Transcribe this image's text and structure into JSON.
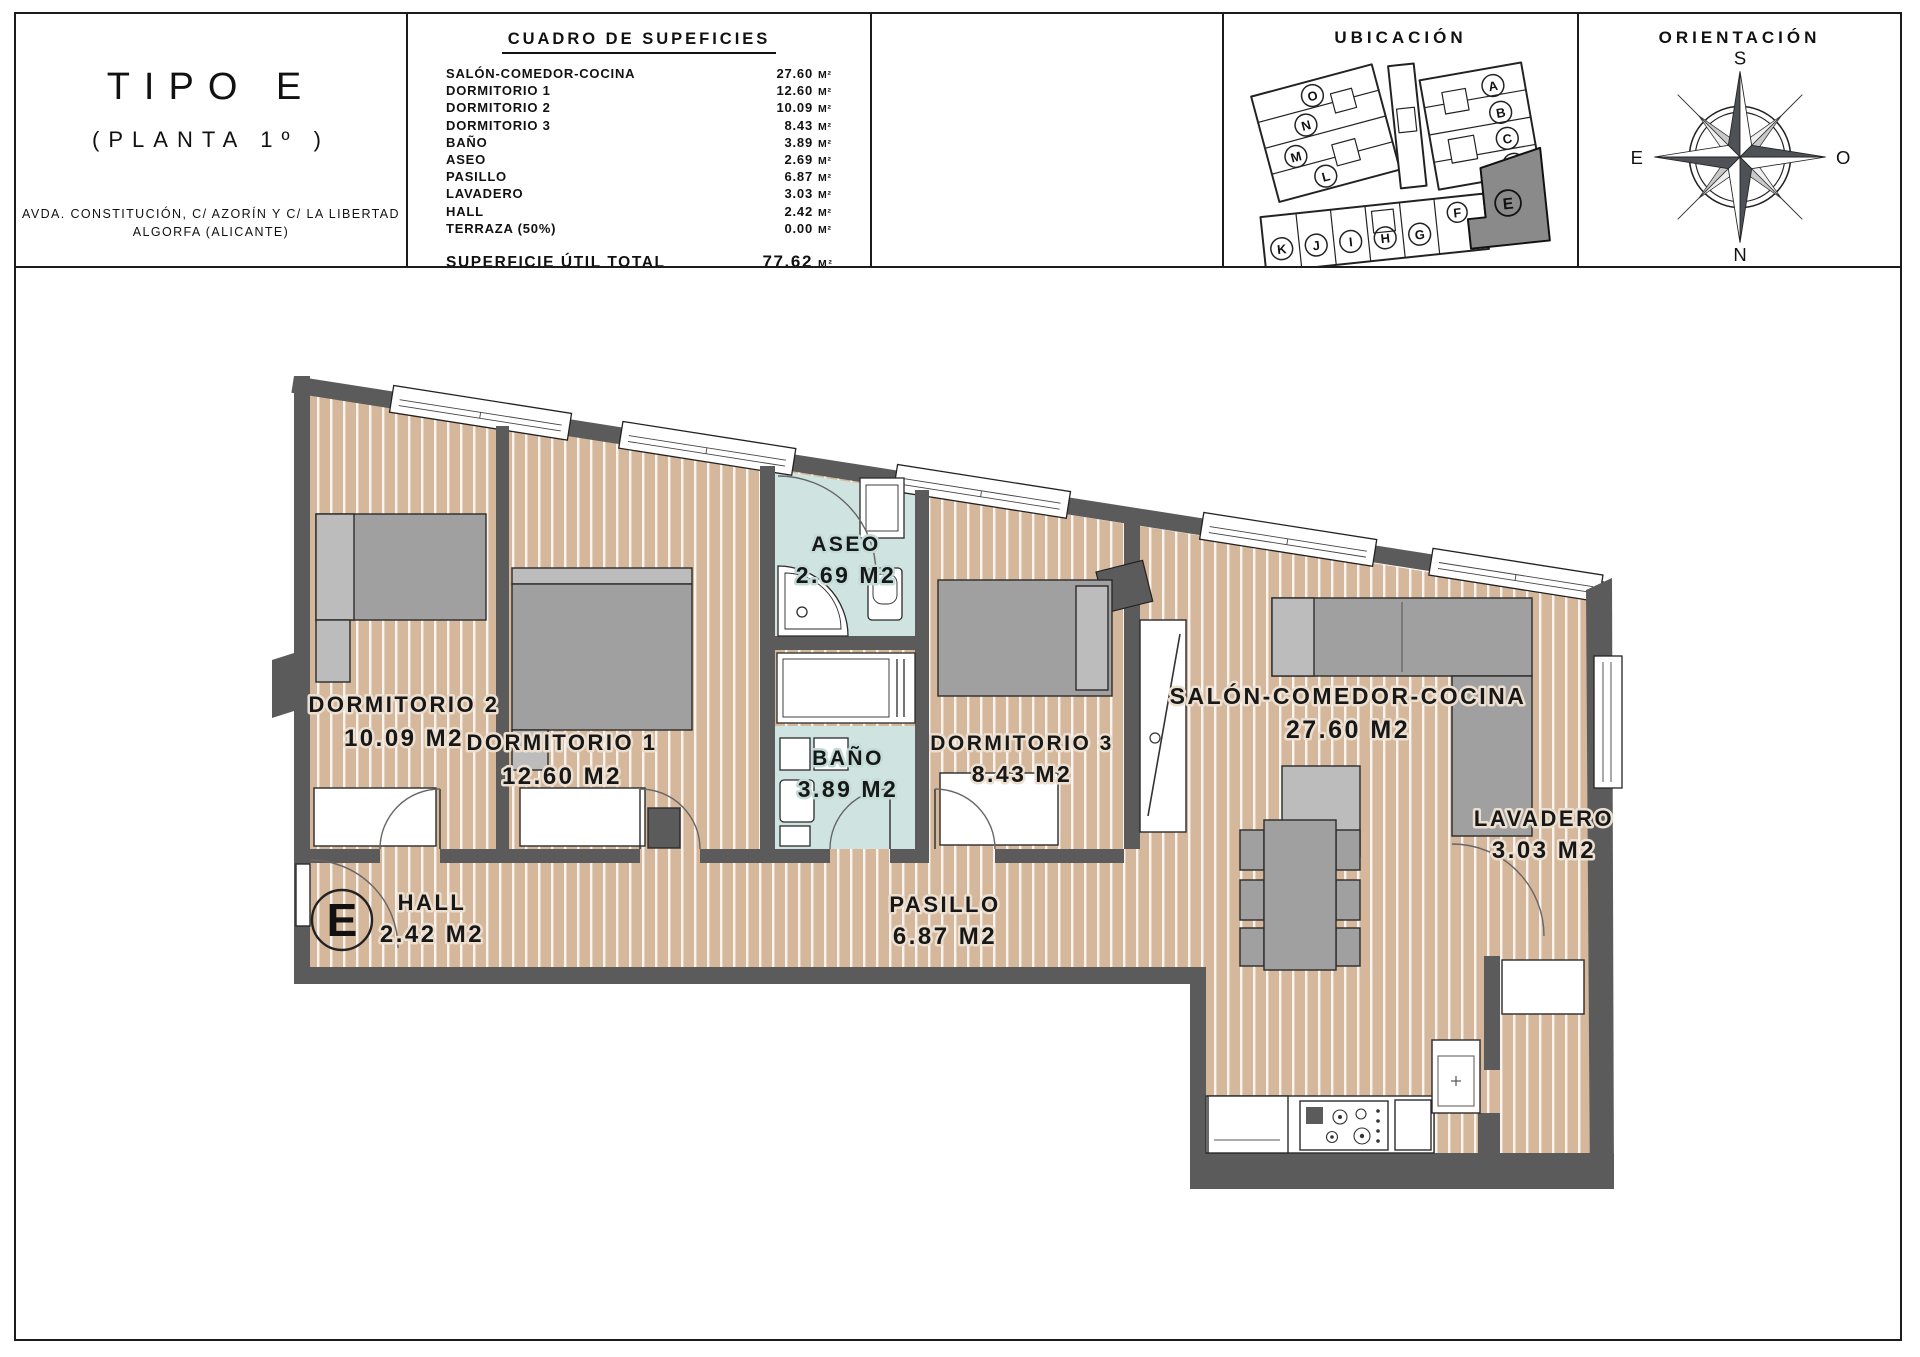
{
  "sheet": {
    "panel1": {
      "title": "TIPO E",
      "subtitle": "(PLANTA 1º )",
      "address1": "AVDA. CONSTITUCIÓN, C/ AZORÍN Y C/ LA LIBERTAD",
      "address2": "ALGORFA (ALICANTE)"
    },
    "surfaces": {
      "title": "CUADRO DE SUPEFICIES",
      "rows": [
        {
          "label": "SALÓN-COMEDOR-COCINA",
          "value": "27.60",
          "unit": "M²"
        },
        {
          "label": "DORMITORIO 1",
          "value": "12.60",
          "unit": "M²"
        },
        {
          "label": "DORMITORIO 2",
          "value": "10.09",
          "unit": "M²"
        },
        {
          "label": "DORMITORIO 3",
          "value": "8.43",
          "unit": "M²"
        },
        {
          "label": "BAÑO",
          "value": "3.89",
          "unit": "M²"
        },
        {
          "label": "ASEO",
          "value": "2.69",
          "unit": "M²"
        },
        {
          "label": "PASILLO",
          "value": "6.87",
          "unit": "M²"
        },
        {
          "label": "LAVADERO",
          "value": "3.03",
          "unit": "M²"
        },
        {
          "label": "HALL",
          "value": "2.42",
          "unit": "M²"
        },
        {
          "label": "TERRAZA (50%)",
          "value": "0.00",
          "unit": "M²"
        }
      ],
      "total": {
        "label": "SUPERFICIE ÚTIL TOTAL",
        "value": "77.62",
        "unit": "M²"
      },
      "terraza100": {
        "label": "TERRAZA (100%)",
        "value": "0.00",
        "unit": "M²"
      }
    },
    "ubicacion": {
      "title": "UBICACIÓN",
      "units": [
        "O",
        "N",
        "M",
        "L",
        "A",
        "B",
        "C",
        "D",
        "K",
        "J",
        "I",
        "H",
        "G",
        "F",
        "E"
      ],
      "highlighted": "E"
    },
    "orientacion": {
      "title": "ORIENTACIÓN",
      "south": "S",
      "north": "N",
      "east": "E",
      "west": "O"
    }
  },
  "plan": {
    "rooms": [
      {
        "name": "DORMITORIO 2",
        "area": "10.09 M2"
      },
      {
        "name": "DORMITORIO 1",
        "area": "12.60 M2"
      },
      {
        "name": "ASEO",
        "area": "2.69 M2"
      },
      {
        "name": "BAÑO",
        "area": "3.89 M2"
      },
      {
        "name": "DORMITORIO 3",
        "area": "8.43 M2"
      },
      {
        "name": "SALÓN-COMEDOR-COCINA",
        "area": "27.60 M2"
      },
      {
        "name": "HALL",
        "area": "2.42 M2"
      },
      {
        "name": "PASILLO",
        "area": "6.87 M2"
      },
      {
        "name": "LAVADERO",
        "area": "3.03 M2"
      }
    ],
    "entrance_marker": "E"
  },
  "colors": {
    "wall": "#5b5b5b",
    "wood_floor": "#d5b79b",
    "floor_stripe": "#ffffff",
    "bath_floor": "#cfe3e0",
    "furniture": "#a0a0a0",
    "furniture_light": "#bcbcbc",
    "fixture_white": "#ffffff",
    "unit_highlight": "#8a8a8a",
    "line": "#2b2b2b"
  }
}
